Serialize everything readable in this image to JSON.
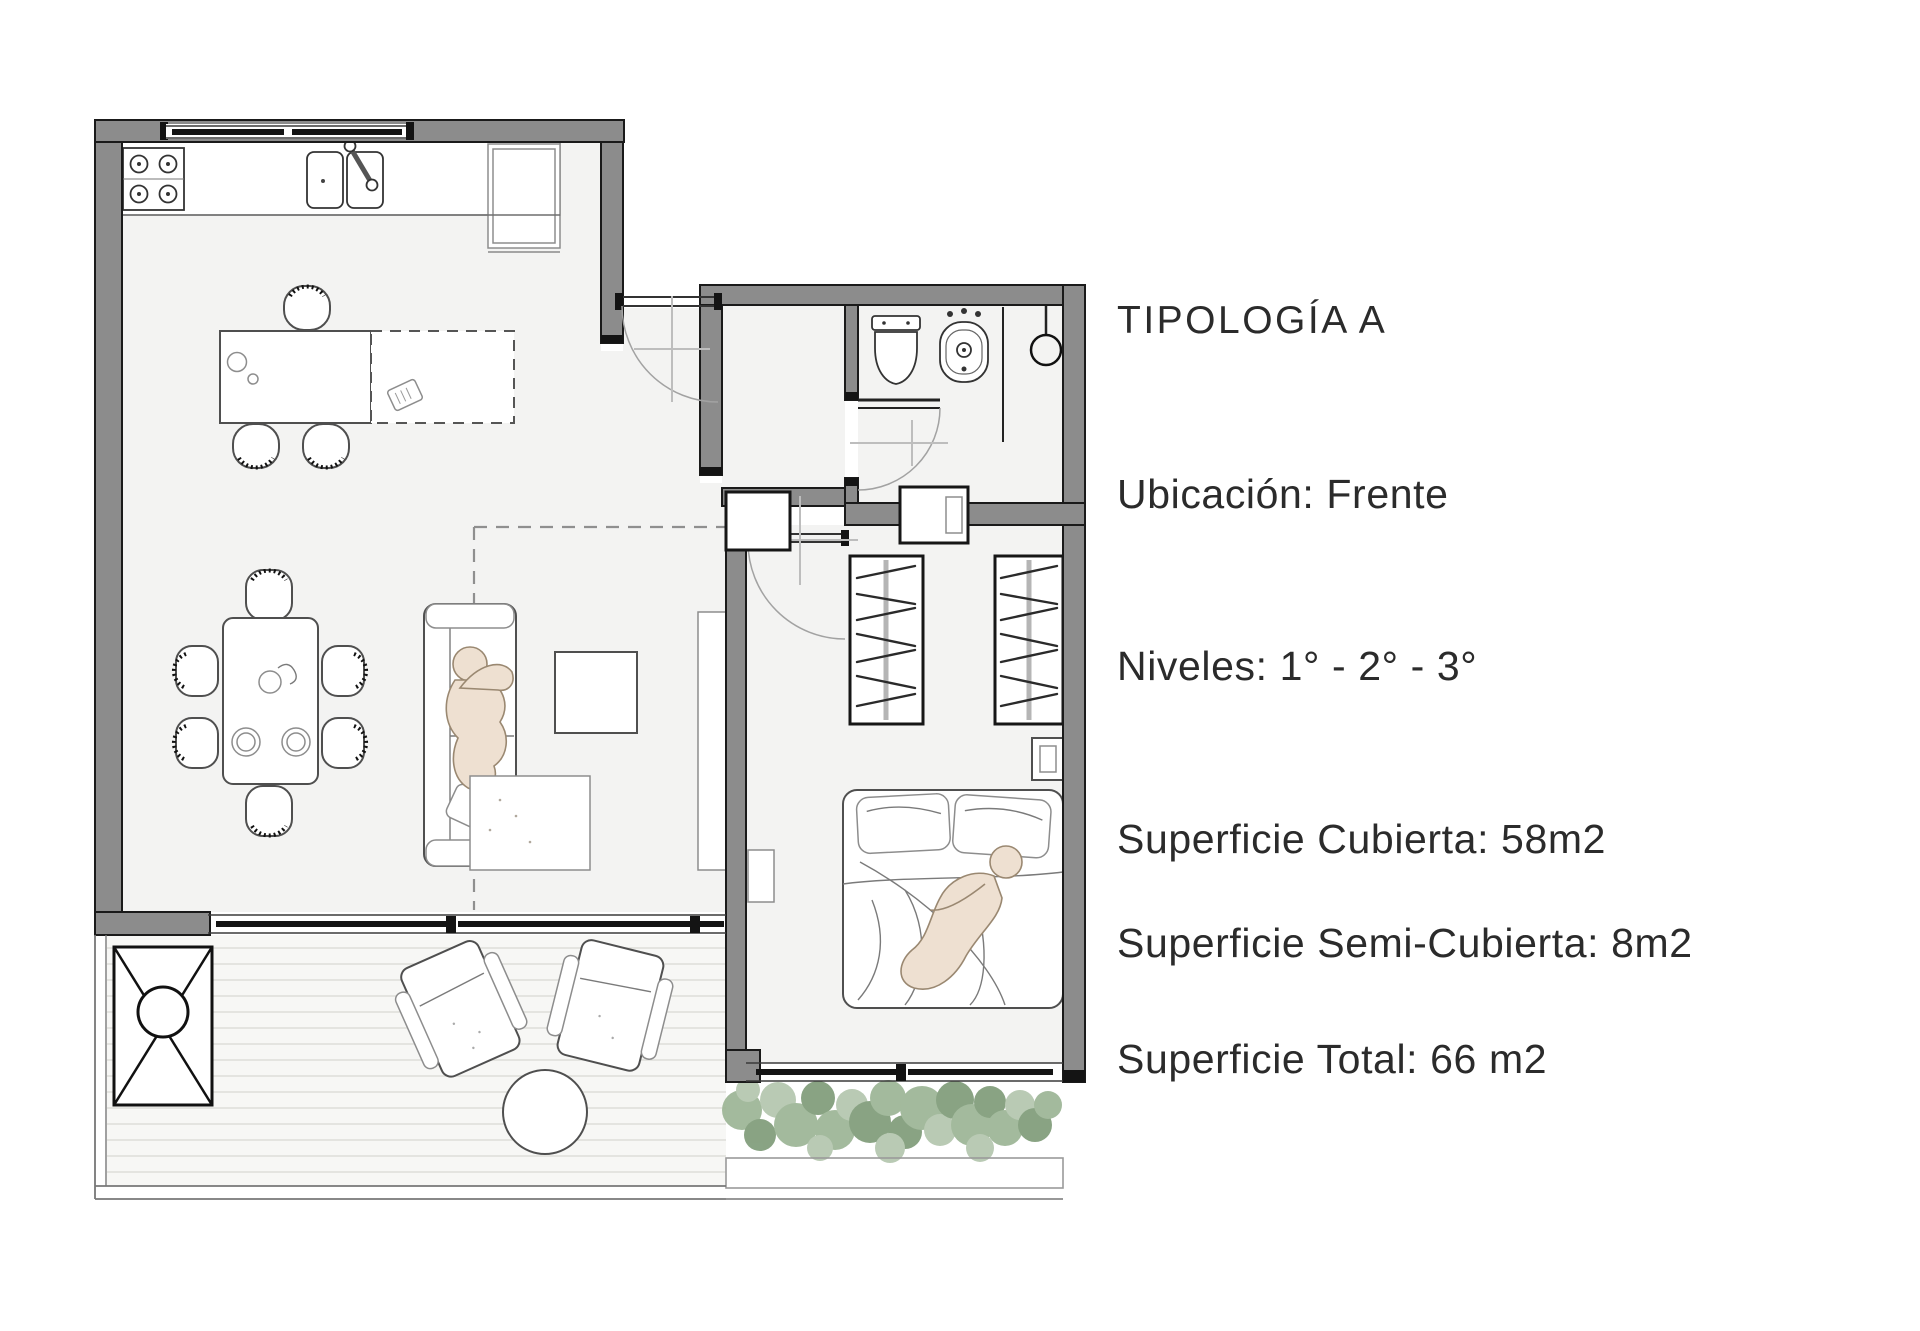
{
  "panel": {
    "title": "TIPOLOGÍA A",
    "location": "Ubicación: Frente",
    "levels": "Niveles: 1° - 2° - 3°",
    "area_covered": "Superficie Cubierta:  58m2",
    "area_semi_covered": "Superficie Semi-Cubierta: 8m2",
    "area_total": "Superficie Total: 66 m2"
  },
  "colors": {
    "wall": "#8c8c8c",
    "wall_outline": "#1a1a1a",
    "floor": "#f3f3f2",
    "deck": "#f7f7f5",
    "text": "#2b2b2b",
    "greenery_light": "#b4c6ae",
    "greenery_mid": "#9cb595",
    "greenery_dark": "#7f9c79"
  }
}
